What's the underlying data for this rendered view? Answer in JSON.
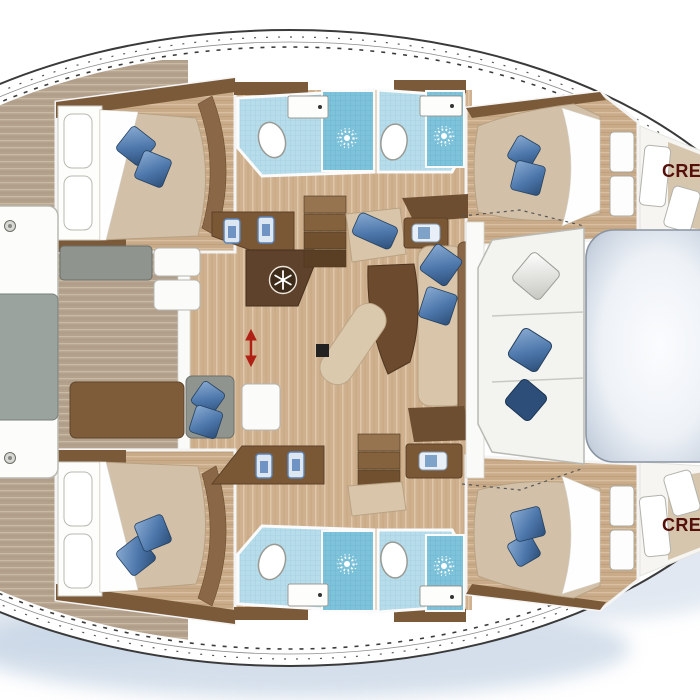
{
  "plan": {
    "type": "catamaran-yacht-floorplan",
    "labels": {
      "crew_top": "CREW",
      "crew_bottom": "CREW"
    },
    "colors": {
      "hull_outline": "#3a3a3a",
      "hull_fill": "#ffffff",
      "water_shadow": "#b9cbdf",
      "cockpit_deck": "#b4a28d",
      "interior_floor": "#cfb18f",
      "dark_wood": "#5f422b",
      "mid_wood": "#7a5836",
      "trim_wood": "#7b5a39",
      "upholstery_beige": "#d8c5aa",
      "duvet_beige": "#d2c0a8",
      "pillow_blue": "#4d77ab",
      "pillow_navy": "#2c4e78",
      "bath_tile_blue": "#b7dcea",
      "shower_blue": "#7fc3db",
      "cushion_gray": "#90948f",
      "trampoline_gray": "#b6c2d2",
      "crew_label_red": "#55100b",
      "arrow_red": "#b02015"
    },
    "icons": [
      "snowflake-icon",
      "shower-drain-icon",
      "double-arrow-icon",
      "cleat-icon"
    ]
  }
}
